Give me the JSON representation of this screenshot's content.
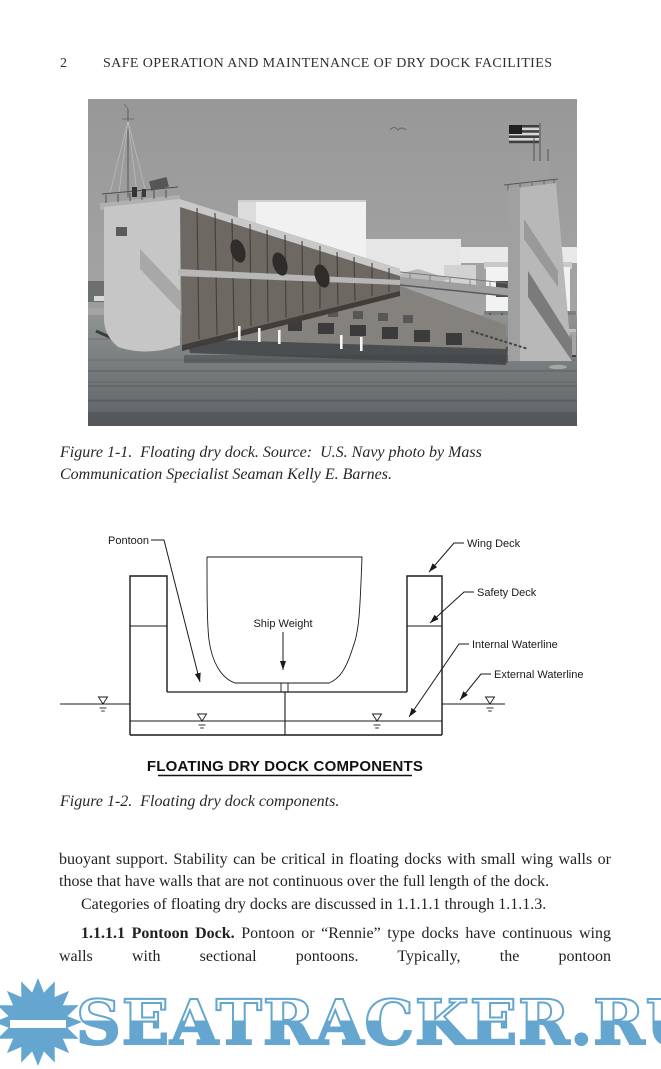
{
  "header": {
    "page_number": "2",
    "title": "SAFE OPERATION AND MAINTENANCE OF DRY DOCK FACILITIES"
  },
  "figure1": {
    "caption": "Figure 1-1.  Floating dry dock. Source:  U.S. Navy photo by Mass Communication Specialist Seaman Kelly E. Barnes.",
    "photo_alt": "Grayscale photograph of a floating dry dock with two wing walls, a walkway between them, a U.S. flag on the right tower, harbor water in front and white buildings behind"
  },
  "diagram": {
    "title": "FLOATING DRY DOCK COMPONENTS",
    "labels": {
      "pontoon": "Pontoon",
      "wing_deck": "Wing Deck",
      "safety_deck": "Safety Deck",
      "internal_waterline": "Internal Waterline",
      "external_waterline": "External Waterline",
      "ship_weight": "Ship Weight"
    }
  },
  "figure2": {
    "caption": "Figure 1-2.  Floating dry dock components."
  },
  "body": {
    "para1": "buoyant support. Stability can be critical in floating docks with small wing walls or those that have walls that are not continuous over the full length of the dock.",
    "para2": "Categories of floating dry docks are discussed in 1.1.1.1 through 1.1.1.3.",
    "para3_lead": "1.1.1.1 Pontoon Dock.",
    "para3_text": "Pontoon or “Rennie” type docks have continuous wing walls with sectional pontoons. Typically, the pontoon"
  },
  "watermark": {
    "text": "SEATRACKER.RU",
    "color": "#64A6CF"
  }
}
